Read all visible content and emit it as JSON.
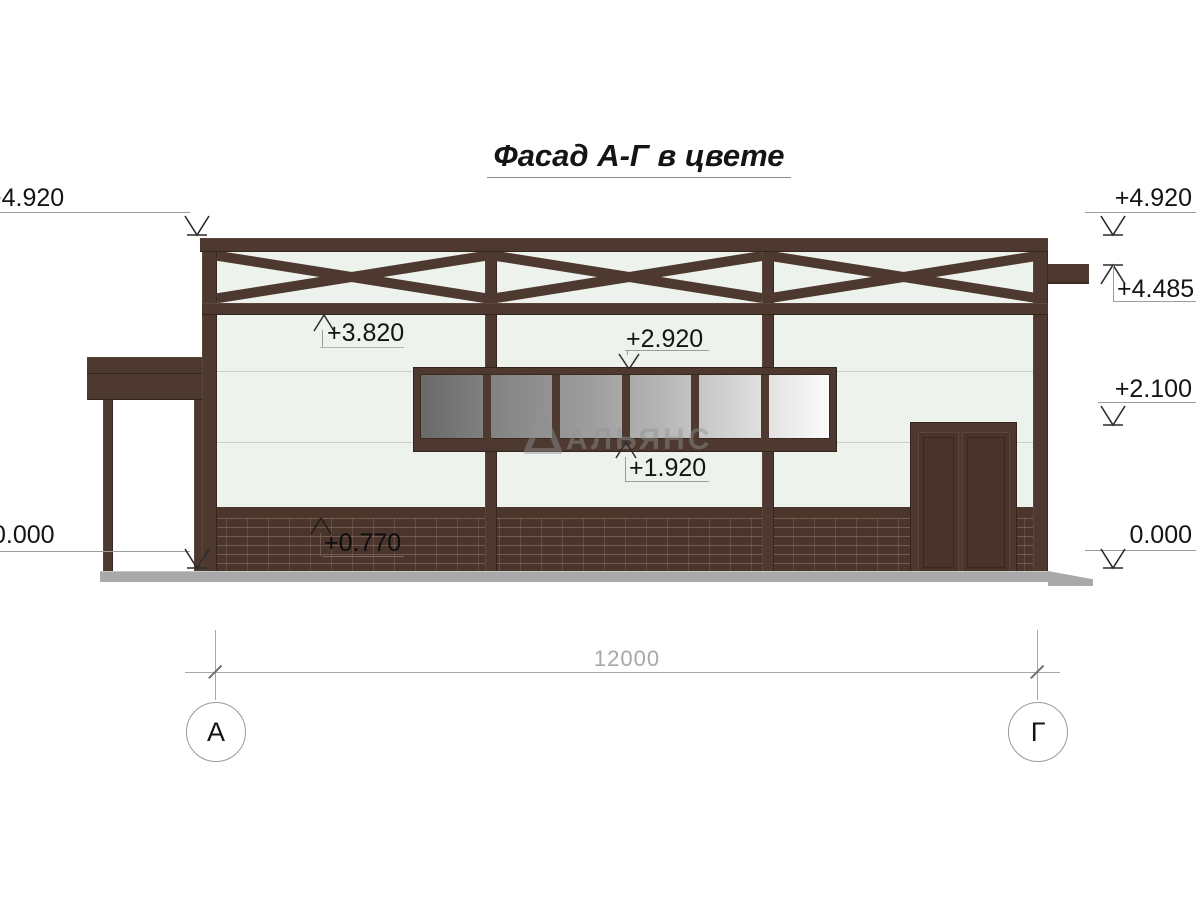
{
  "title": "Фасад А-Г в цвете",
  "watermark": "АЛЬЯНС",
  "elevations": {
    "top_left": "+4.920",
    "top_right": "+4.920",
    "eave_right": "+4.485",
    "truss_bottom": "+3.820",
    "window_head": "+2.920",
    "mid_right": "+2.100",
    "window_sill": "+1.920",
    "plinth_top": "+0.770",
    "zero_left": "0.000",
    "zero_right": "0.000"
  },
  "dimensions": {
    "overall_width": "12000"
  },
  "axes": {
    "left": "А",
    "right": "Г"
  },
  "colors": {
    "frame_brown": "#4e3930",
    "brick": "#4b342b",
    "wall": "#edf3ec",
    "glass_dark": "#6a6a6a",
    "glass_light": "#fbfbfb",
    "ground": "#a9a9a9",
    "annotation_gray": "#9c9c9c"
  }
}
